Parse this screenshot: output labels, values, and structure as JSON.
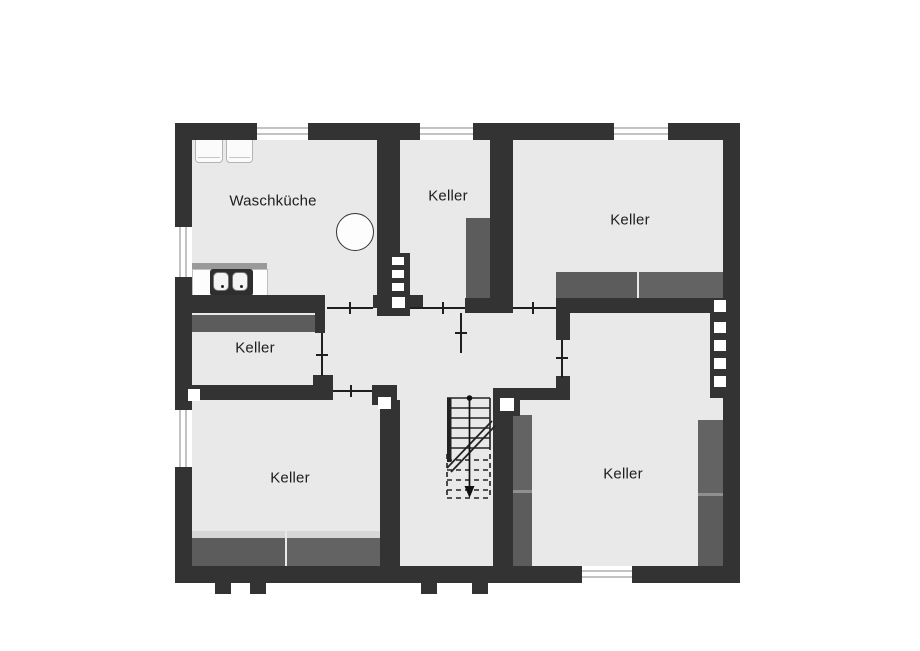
{
  "floor_plan": {
    "rooms": [
      {
        "id": "waschkueche",
        "label": "Waschküche"
      },
      {
        "id": "keller_top_middle",
        "label": "Keller"
      },
      {
        "id": "keller_top_right",
        "label": "Keller"
      },
      {
        "id": "keller_middle_left",
        "label": "Keller"
      },
      {
        "id": "keller_bottom_left",
        "label": "Keller"
      },
      {
        "id": "keller_bottom_right",
        "label": "Keller"
      }
    ],
    "fixtures": {
      "sink_icon": "double-basin-sink-icon",
      "appliance_icons": "washer-dryer-outline-icons",
      "boiler_icon": "round-boiler-icon",
      "stairs_icon": "staircase-down-icon",
      "stairs_direction": "down"
    },
    "colors": {
      "wall": "#333333",
      "floor": "#e9e9e9",
      "shelf": "#5c5c5c",
      "background": "#ffffff",
      "window_line": "#c3c3c3",
      "label_text": "#1d1d1d"
    }
  }
}
